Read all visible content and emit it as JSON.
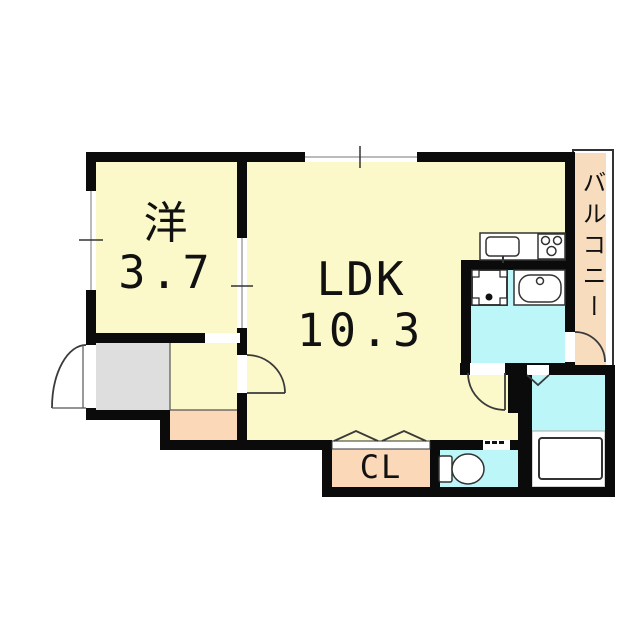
{
  "floorplan": {
    "rooms": {
      "western": {
        "name": "洋",
        "area": "3.7"
      },
      "ldk": {
        "name": "LDK",
        "area": "10.3"
      },
      "closet": {
        "name": "CL"
      },
      "balcony": {
        "name": "バルコニー"
      }
    },
    "colors": {
      "room_fill": "#FBF8C9",
      "wet_area_fill": "#BCF6F8",
      "balcony_fill": "#F7DCBE",
      "closet_fill": "#FAD8B8",
      "entrance_fill": "#DEDEDE",
      "wall": "#0B0B0B"
    }
  }
}
